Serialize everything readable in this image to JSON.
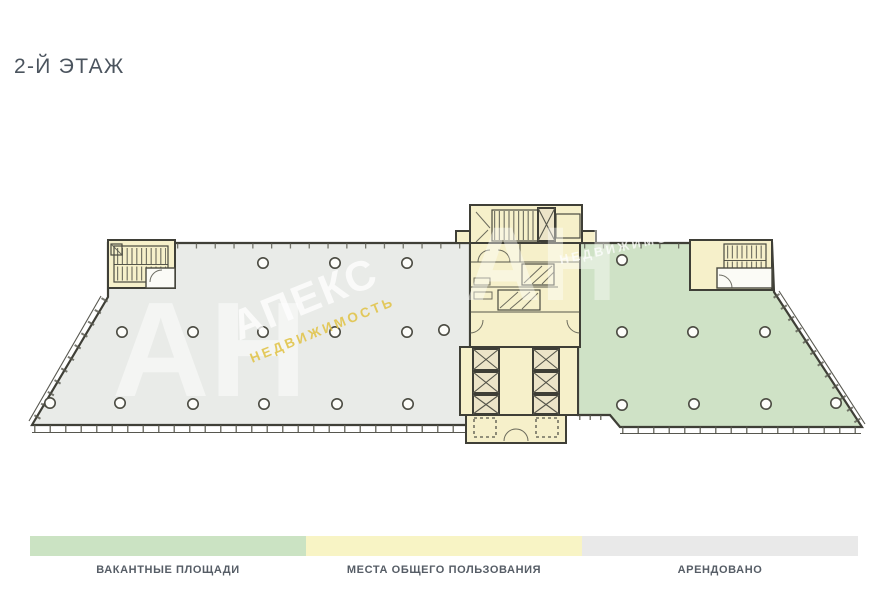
{
  "title": "2-Й ЭТАЖ",
  "floor_plan": {
    "description": "План этажа офисного здания",
    "areas": [
      {
        "id": "rented-left",
        "label": "АРЕНДОВАНО",
        "color": "#e9ebe8"
      },
      {
        "id": "vacant-right",
        "label": "ВАКАНТНЫЕ ПЛОЩАДИ",
        "color": "#cfe2c6"
      },
      {
        "id": "common-core",
        "label": "МЕСТА ОБЩЕГО ПОЛЬЗОВАНИЯ",
        "color": "#f6f0ca"
      }
    ],
    "wall_color": "#3f3f37"
  },
  "watermark": {
    "initials": "АН",
    "brand": "АПЕКС",
    "subbrand": "НЕДВИЖИМОСТЬ",
    "accent_color": "#e2c54c"
  },
  "legend": {
    "items": [
      {
        "label": "ВАКАНТНЫЕ ПЛОЩАДИ",
        "color": "#cbe3c3"
      },
      {
        "label": "МЕСТА ОБЩЕГО ПОЛЬЗОВАНИЯ",
        "color": "#f8f4c5"
      },
      {
        "label": "АРЕНДОВАНО",
        "color": "#e9e9e9"
      }
    ]
  }
}
